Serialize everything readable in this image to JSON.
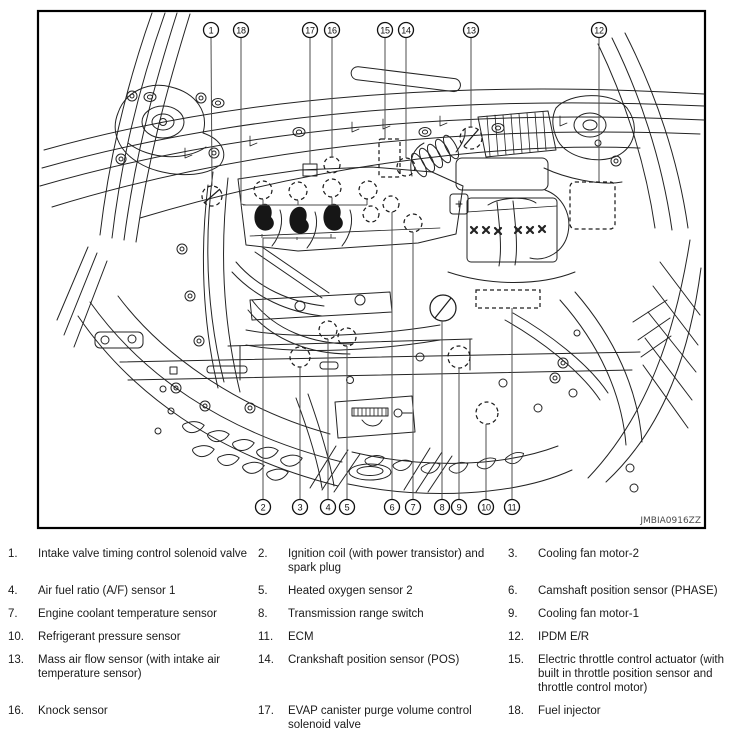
{
  "figure": {
    "watermark": "JMBIA0916ZZ",
    "callouts": {
      "top": [
        "1",
        "18",
        "17",
        "16",
        "15",
        "14",
        "13",
        "12"
      ],
      "bottom": [
        "2",
        "3",
        "4",
        "5",
        "6",
        "7",
        "8",
        "9",
        "10",
        "11"
      ]
    }
  },
  "legend": {
    "items": [
      {
        "num": "1.",
        "text": "Intake valve timing control solenoid valve"
      },
      {
        "num": "2.",
        "text": "Ignition coil (with power transistor) and spark plug"
      },
      {
        "num": "3.",
        "text": "Cooling fan motor-2"
      },
      {
        "num": "4.",
        "text": "Air fuel ratio (A/F) sensor 1"
      },
      {
        "num": "5.",
        "text": "Heated oxygen sensor 2"
      },
      {
        "num": "6.",
        "text": "Camshaft position sensor (PHASE)"
      },
      {
        "num": "7.",
        "text": "Engine coolant temperature sensor"
      },
      {
        "num": "8.",
        "text": "Transmission range switch"
      },
      {
        "num": "9.",
        "text": "Cooling fan motor-1"
      },
      {
        "num": "10.",
        "text": "Refrigerant pressure sensor"
      },
      {
        "num": "11.",
        "text": "ECM"
      },
      {
        "num": "12.",
        "text": "IPDM E/R"
      },
      {
        "num": "13.",
        "text": "Mass air flow sensor (with intake air temperature sensor)"
      },
      {
        "num": "14.",
        "text": "Crankshaft position sensor (POS)"
      },
      {
        "num": "15.",
        "text": "Electric throttle control actuator (with built in throttle position sensor and throttle control motor)"
      },
      {
        "num": "16.",
        "text": "Knock sensor"
      },
      {
        "num": "17.",
        "text": "EVAP canister purge volume control solenoid valve"
      },
      {
        "num": "18.",
        "text": "Fuel injector"
      }
    ]
  }
}
